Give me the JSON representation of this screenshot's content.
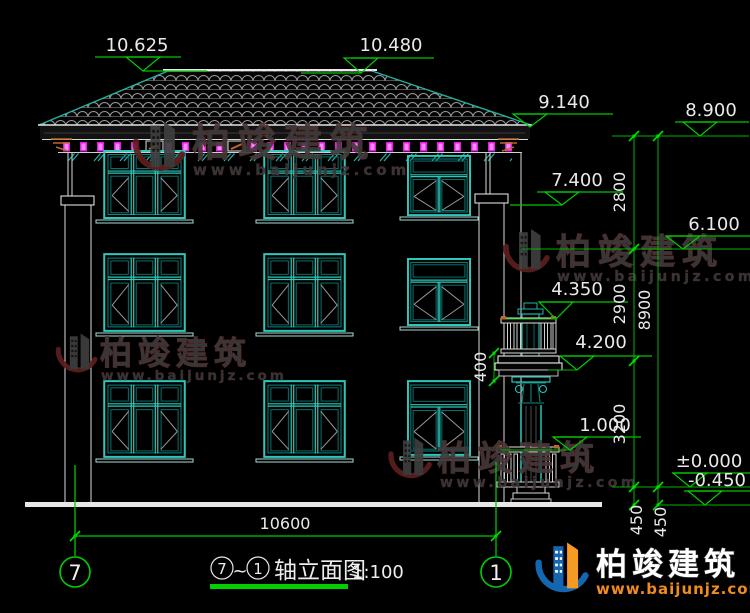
{
  "levels": {
    "ridge_left": "10.625",
    "ridge_right": "10.480",
    "eave": "9.140",
    "right_top": "8.900",
    "porch_roof": "7.400",
    "mid": "6.100",
    "balcony_rail": "4.350",
    "balcony_slab": "4.200",
    "porch_rail": "1.000",
    "zero": "±0.000",
    "below_grade": "-0.450"
  },
  "dims": {
    "floor3": "2800",
    "floor2": "2900",
    "floor1": "3200",
    "total_height": "8900",
    "plinth_a": "450",
    "plinth_b": "450",
    "balcony_beam": "400",
    "overall_width": "10600"
  },
  "axes": {
    "left": "7",
    "right": "1"
  },
  "title": {
    "axis_left": "7",
    "tilde": "~",
    "axis_right": "1",
    "text": "轴立面图",
    "scale": "1:100"
  },
  "watermark": {
    "name": "柏竣建筑",
    "url": "www.baijunjz.com"
  },
  "brand": {
    "name": "柏竣建筑",
    "url": "www.baijunjz.com"
  }
}
